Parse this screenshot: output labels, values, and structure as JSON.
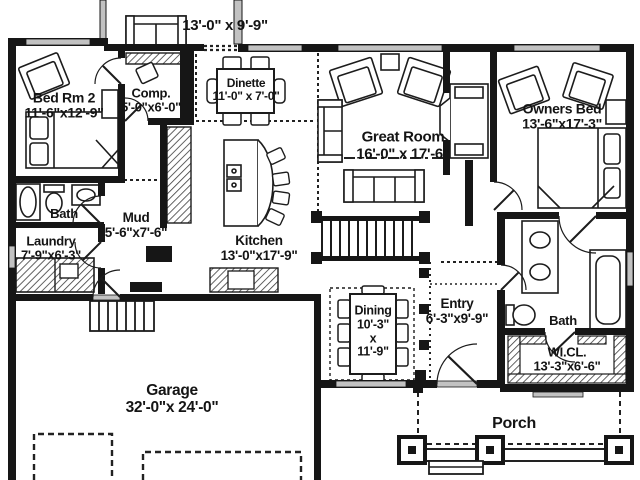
{
  "plan": {
    "type": "residential-floor-plan",
    "rooms": {
      "deck": {
        "dims": "13'-0\" x 9'-9\""
      },
      "bedrm2": {
        "name": "Bed Rm 2",
        "dims": "11'-6\"x12'-9\""
      },
      "comp": {
        "name": "Comp.",
        "dims": "5'-0\"x6'-0\""
      },
      "dinette": {
        "name": "Dinette",
        "dims": "11'-0\" x 7'-0\""
      },
      "great": {
        "name": "Great Room",
        "dims": "16'-0\" x 17'-6\""
      },
      "owners": {
        "name": "Owners Bed",
        "dims": "13'-6\"x17'-3\""
      },
      "bath1": {
        "name": "Bath"
      },
      "laundry": {
        "name": "Laundry",
        "dims": "7'-9\"x6'-3\""
      },
      "mud": {
        "name": "Mud",
        "dims": "5'-6\"x7'-6\""
      },
      "kitchen": {
        "name": "Kitchen",
        "dims": "13'-0\"x17'-9\""
      },
      "dining": {
        "name": "Dining",
        "dims_w": "10'-3\"",
        "dims_x": "x",
        "dims_h": "11'-9\""
      },
      "entry": {
        "name": "Entry",
        "dims": "6'-3\"x9'-9\""
      },
      "bath2": {
        "name": "Bath"
      },
      "wicl": {
        "name": "WI.CL.",
        "dims": "13'-3\"x6'-6\""
      },
      "garage": {
        "name": "Garage",
        "dims": "32'-0\"x 24'-0\""
      },
      "porch": {
        "name": "Porch"
      }
    },
    "colors": {
      "wall": "#161616",
      "window": "#c2c2c2",
      "line": "#222222",
      "bg": "#ffffff"
    }
  }
}
